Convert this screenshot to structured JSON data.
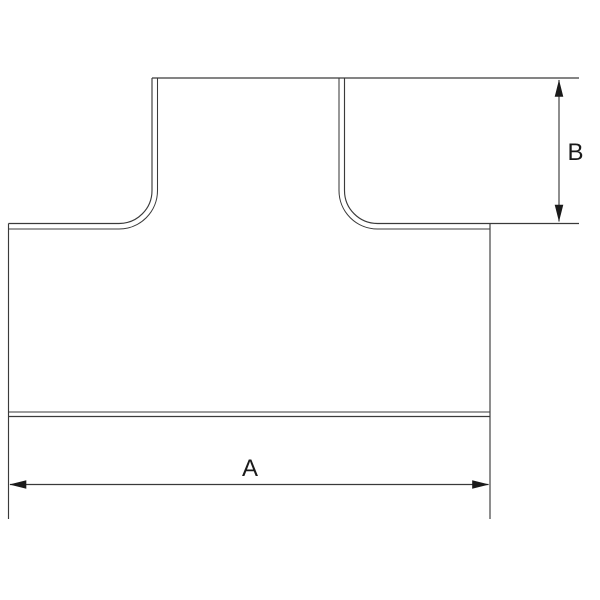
{
  "page": {
    "background_color": "#ffffff"
  },
  "drawing": {
    "type": "technical-drawing",
    "subject": "pipe-tee-fitting-front-view",
    "outline_color": "#3a3a3a",
    "dimension_color": "#1a1a1a",
    "labels": {
      "a": "A",
      "b": "B"
    },
    "dimensions": [
      {
        "label": "A",
        "orientation": "horizontal"
      },
      {
        "label": "B",
        "orientation": "vertical"
      }
    ]
  }
}
